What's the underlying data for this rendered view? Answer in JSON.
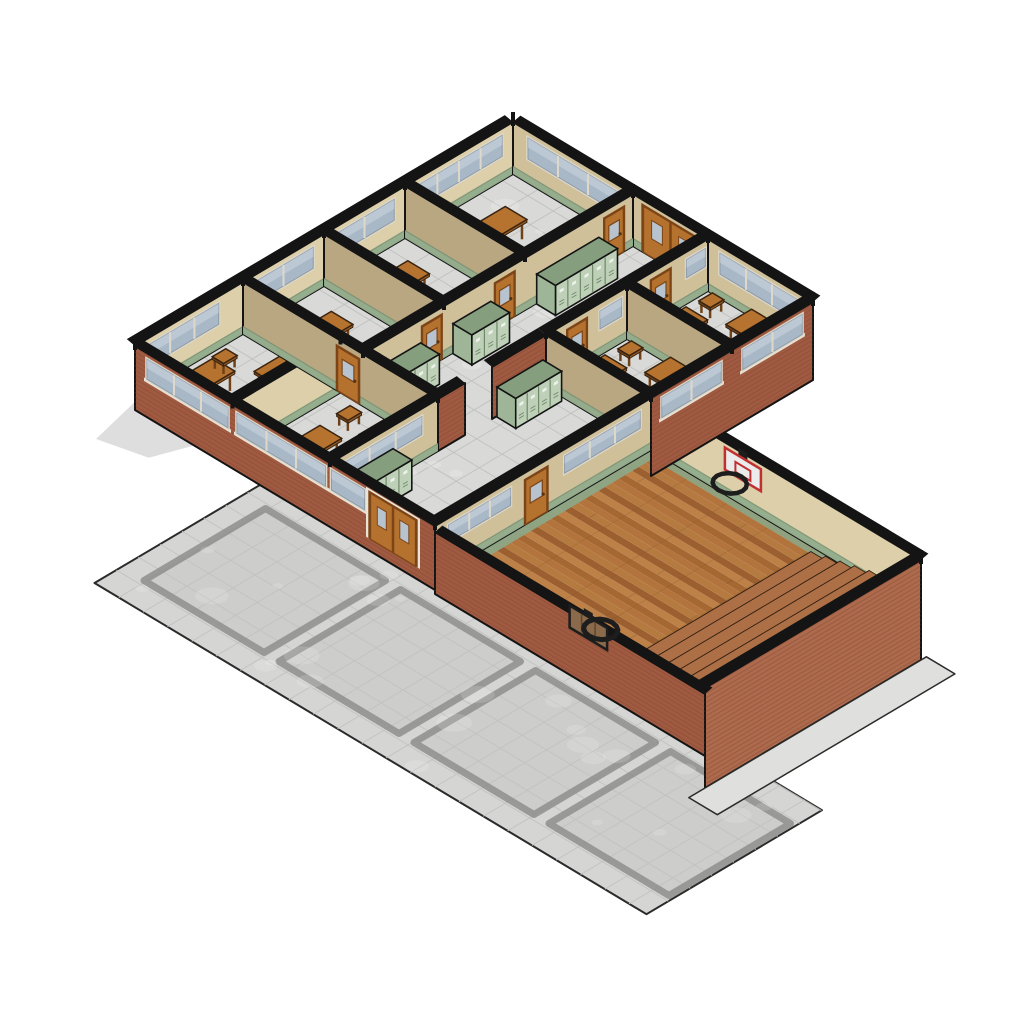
{
  "scene_name": "isometric-school-building-model",
  "palette": {
    "background": "#ffffff",
    "outline": "#141414",
    "wallTanLight": "#dccfa9",
    "wallTan": "#cfc09a",
    "wallTanDark": "#b9a782",
    "wainscot": "#93ac8c",
    "wainscotDark": "#768f70",
    "brick": "#a05a41",
    "brickLight": "#ad6a4d",
    "brickDark": "#7c4530",
    "tileFloor": "#d9dad8",
    "tileLine": "#bfc0be",
    "plaza": "#d5d6d4",
    "plazaLine": "#c2c3c1",
    "plazaInset": "#cdcecc",
    "plazaGroove": "#8e8f8d",
    "sidewalk": "#dfe0dd",
    "wood": [
      "#b2743c",
      "#a66832",
      "#bd8148",
      "#9c6030",
      "#b57a40"
    ],
    "woodSeam": "#7e5224",
    "gymTrim": "#8da787",
    "bleacherTop": "#ad6f46",
    "bleacherRiser": "#7f4e33",
    "lockerFront": "#bed0b7",
    "lockerSide": "#9eb697",
    "lockerTop": "#859e7d",
    "lockerLine": "#5f7a59",
    "lockerPlate": "#edf2ea",
    "door": "#b5722e",
    "doorDark": "#7d4517",
    "doorGlass": "#b7c3cf",
    "glass": "#a9b8c7",
    "glassLight": "#ccd5de",
    "frame": "#ddd8ca",
    "sill": "#e9e4d5",
    "deskTop": "#b5732f",
    "deskSide": "#9a5c26",
    "deskLeg": "#6f4119",
    "backboard": "#ebebeb",
    "backboardTrim": "#c03030",
    "backboardRear": "#8a6a4a",
    "slat": "#5f4630",
    "hoopRim": "#1d1d1d",
    "shadow": "rgba(70,70,70,0.18)"
  },
  "iso": {
    "origin": [
      135,
      398
    ],
    "ua": [
      13.5,
      -8
    ],
    "ub": [
      15,
      9
    ],
    "wallHeight": 52
  },
  "plaza": {
    "a1": -13,
    "a2": 0,
    "b1": 9,
    "b2": 45.8,
    "tile": 1.62,
    "squares": [
      [
        -11,
        -2,
        10.5,
        18.5
      ],
      [
        -11,
        -2,
        19.5,
        27.5
      ],
      [
        -11,
        -2,
        28.5,
        36.5
      ],
      [
        -11,
        -2,
        37.5,
        45.5
      ]
    ]
  },
  "shadow": [
    [
      -0.2,
      0.2
    ],
    [
      -4,
      1
    ],
    [
      -3.2,
      3.8
    ],
    [
      -0.2,
      4.8
    ]
  ],
  "wingFloor": {
    "a1": 0,
    "a2": 28,
    "b1": 0,
    "b2": 20,
    "tile": 1.7
  },
  "gymFloor": {
    "a1": 0,
    "a2": 16,
    "b1": 20,
    "b2": 38,
    "plank": 0.5
  },
  "sidewalkStrip": [
    [
      -1.2,
      38
    ],
    [
      16.4,
      38
    ],
    [
      16.4,
      39.9
    ],
    [
      -1.2,
      39.9
    ]
  ],
  "walls": [
    {
      "id": "wall-nw-exterior",
      "p1": [
        0,
        0
      ],
      "p2": [
        28,
        0
      ],
      "fill": "wallTanLight",
      "cap": [
        0,
        -0.55
      ],
      "feats": [
        {
          "t": "wains"
        },
        {
          "t": "win",
          "u": [
            0.8,
            6.2
          ],
          "y": [
            24,
            45
          ]
        },
        {
          "t": "win",
          "u": [
            8.8,
            13.2
          ],
          "y": [
            24,
            45
          ]
        },
        {
          "t": "win",
          "u": [
            14.8,
            19.2
          ],
          "y": [
            24,
            45
          ]
        },
        {
          "t": "win",
          "u": [
            20.8,
            27.2
          ],
          "y": [
            24,
            45
          ]
        }
      ]
    },
    {
      "id": "wall-ne-exterior",
      "p1": [
        28,
        0
      ],
      "p2": [
        28,
        20
      ],
      "fill": "wallTan",
      "cap": [
        0.55,
        0
      ],
      "feats": [
        {
          "t": "wains"
        },
        {
          "t": "win",
          "u": [
            1,
            7
          ],
          "y": [
            24,
            45
          ]
        },
        {
          "t": "ddoor",
          "u": [
            8.7,
            12.3
          ],
          "y": [
            0,
            46
          ]
        },
        {
          "t": "win",
          "u": [
            13.8,
            19
          ],
          "y": [
            24,
            45
          ]
        }
      ]
    },
    {
      "id": "wall-sw-exterior",
      "p1": [
        0,
        0
      ],
      "p2": [
        0,
        20
      ],
      "fill": "brick",
      "drop": 12,
      "cap": [
        0.55,
        0
      ],
      "feats": [
        {
          "t": "winB",
          "u": [
            0.8,
            6.2
          ],
          "y": [
            26,
            46
          ]
        },
        {
          "t": "winB",
          "u": [
            6.8,
            12.7
          ],
          "y": [
            26,
            46
          ]
        },
        {
          "t": "winB",
          "u": [
            13.1,
            15.3
          ],
          "y": [
            26,
            46
          ]
        },
        {
          "t": "ddoorB",
          "u": [
            15.7,
            18.7
          ],
          "y": [
            0,
            46
          ]
        }
      ]
    },
    {
      "id": "wall-se-classrooms",
      "p1": [
        16,
        20
      ],
      "p2": [
        28,
        20
      ],
      "fill": "brick",
      "drop": 26,
      "cap": [
        0,
        -0.55
      ],
      "feats": [
        {
          "t": "winB",
          "u": [
            0.8,
            5.2
          ],
          "y": [
            26,
            46
          ]
        },
        {
          "t": "winB",
          "u": [
            6.8,
            11.2
          ],
          "y": [
            26,
            46
          ]
        }
      ]
    },
    {
      "id": "wall-room-divider-b65",
      "p1": [
        0,
        6.5
      ],
      "p2": [
        8,
        6.5
      ],
      "fill": "wallTanLight",
      "cap": [
        0,
        -0.55
      ],
      "feats": [
        {
          "t": "wains"
        }
      ]
    },
    {
      "id": "wall-a8",
      "p1": [
        8,
        0
      ],
      "p2": [
        8,
        13
      ],
      "fill": "wallTanDark",
      "cap": [
        0.55,
        0
      ],
      "feats": [
        {
          "t": "wains"
        },
        {
          "t": "door",
          "u": [
            6.3,
            7.7
          ],
          "y": [
            0,
            44
          ]
        }
      ]
    },
    {
      "id": "wall-hall-north",
      "p1": [
        8,
        8
      ],
      "p2": [
        28,
        8
      ],
      "fill": "wallTan",
      "cap": [
        0,
        -0.55
      ],
      "feats": [
        {
          "t": "wains"
        },
        {
          "t": "door",
          "u": [
            4.4,
            5.8
          ],
          "y": [
            0,
            44
          ]
        },
        {
          "t": "door",
          "u": [
            9.8,
            11.2
          ],
          "y": [
            0,
            44
          ]
        },
        {
          "t": "door",
          "u": [
            17.9,
            19.3
          ],
          "y": [
            0,
            44
          ]
        }
      ]
    },
    {
      "id": "wall-a14",
      "p1": [
        14,
        0
      ],
      "p2": [
        14,
        8
      ],
      "fill": "wallTanDark",
      "cap": [
        0.55,
        0
      ],
      "feats": [
        {
          "t": "wains"
        }
      ]
    },
    {
      "id": "wall-a20",
      "p1": [
        20,
        0
      ],
      "p2": [
        20,
        8
      ],
      "fill": "wallTanDark",
      "cap": [
        0.55,
        0
      ],
      "feats": [
        {
          "t": "wains"
        }
      ]
    },
    {
      "id": "wall-brick-pier-west",
      "p1": [
        8,
        13
      ],
      "p2": [
        10,
        13
      ],
      "fill": "brick",
      "cap": [
        0,
        -0.55
      ],
      "feats": []
    },
    {
      "id": "wall-brick-pier-east",
      "p1": [
        12,
        13
      ],
      "p2": [
        16,
        13
      ],
      "fill": "brick",
      "cap": [
        0,
        -0.55
      ],
      "feats": []
    },
    {
      "id": "wall-lobby-north",
      "p1": [
        0,
        13
      ],
      "p2": [
        8,
        13
      ],
      "fill": "wallTan",
      "cap": [
        0,
        -0.55
      ],
      "feats": [
        {
          "t": "wains"
        },
        {
          "t": "win",
          "u": [
            1,
            6.8
          ],
          "y": [
            26,
            44
          ]
        }
      ]
    },
    {
      "id": "wall-hall-south-east",
      "p1": [
        16,
        13
      ],
      "p2": [
        28,
        13
      ],
      "fill": "wallTan",
      "cap": [
        0,
        -0.55
      ],
      "feats": [
        {
          "t": "wains"
        },
        {
          "t": "door",
          "u": [
            1.6,
            3
          ],
          "y": [
            0,
            44
          ]
        },
        {
          "t": "win",
          "u": [
            4,
            5.6
          ],
          "y": [
            26,
            44
          ]
        },
        {
          "t": "door",
          "u": [
            7.8,
            9.2
          ],
          "y": [
            0,
            44
          ]
        },
        {
          "t": "win",
          "u": [
            10.4,
            11.8
          ],
          "y": [
            26,
            44
          ]
        }
      ]
    },
    {
      "id": "wall-a16-lobby",
      "p1": [
        16,
        13
      ],
      "p2": [
        16,
        20
      ],
      "fill": "wallTanDark",
      "cap": [
        0.55,
        0
      ],
      "feats": [
        {
          "t": "wains"
        }
      ]
    },
    {
      "id": "wall-a22",
      "p1": [
        22,
        13
      ],
      "p2": [
        22,
        20
      ],
      "fill": "wallTanDark",
      "cap": [
        0.55,
        0
      ],
      "feats": [
        {
          "t": "wains"
        }
      ]
    },
    {
      "id": "wall-gym-northwest",
      "p1": [
        0,
        20
      ],
      "p2": [
        16,
        20
      ],
      "fill": "wallTan",
      "cap": [
        0,
        -0.55
      ],
      "feats": [
        {
          "t": "wains"
        },
        {
          "t": "win",
          "u": [
            1,
            5.6
          ],
          "y": [
            28,
            45
          ]
        },
        {
          "t": "door",
          "u": [
            6.7,
            8.3
          ],
          "y": [
            0,
            44
          ]
        },
        {
          "t": "win",
          "u": [
            9.6,
            15.2
          ],
          "y": [
            28,
            45
          ]
        }
      ]
    },
    {
      "id": "wall-gym-northeast",
      "p1": [
        16,
        20
      ],
      "p2": [
        16,
        38
      ],
      "fill": "wallTanLight",
      "cap": [
        0.55,
        0
      ],
      "feats": [
        {
          "t": "wains"
        }
      ]
    },
    {
      "id": "wall-gym-southeast",
      "p1": [
        0,
        38
      ],
      "p2": [
        16,
        38
      ],
      "fill": "brickLight",
      "drop": 48,
      "cap": [
        0,
        -0.55
      ],
      "feats": []
    },
    {
      "id": "wall-gym-southwest",
      "p1": [
        0,
        20
      ],
      "p2": [
        0,
        38
      ],
      "h": 46,
      "fill": "brick",
      "drop": 16,
      "cap": [
        0.55,
        0
      ],
      "feats": []
    }
  ],
  "lockers": [
    {
      "id": "locker-bank-hall-1",
      "a1": 8.6,
      "a2": 12.2,
      "b": 8.06
    },
    {
      "id": "locker-bank-hall-2",
      "a1": 14.6,
      "a2": 17.4,
      "b": 8.06
    },
    {
      "id": "locker-bank-hall-3",
      "a1": 20.8,
      "a2": 25.4,
      "b": 8.06
    },
    {
      "id": "locker-bank-lobby-1",
      "a1": 0.8,
      "a2": 4.6,
      "b": 13.06
    },
    {
      "id": "locker-bank-lobby-2",
      "a1": 12.3,
      "a2": 15.7,
      "b": 13.06
    }
  ],
  "furniture": {
    "classroom-west-a": {
      "tables": [
        [
          3.2,
          2.2
        ],
        [
          5.8,
          4.3
        ]
      ],
      "stools": [
        [
          2.3,
          4.8
        ],
        [
          5.2,
          1.3
        ]
      ]
    },
    "classroom-west-b": {
      "tables": [
        [
          3,
          9.5
        ],
        [
          5.8,
          11.3
        ]
      ],
      "stools": [
        [
          2.2,
          11.8
        ],
        [
          6.3,
          8.6
        ]
      ]
    },
    "classroom-north-a": {
      "tables": [
        [
          10.5,
          3.5
        ]
      ],
      "stools": [
        [
          12.3,
          5.6
        ]
      ]
    },
    "classroom-north-b": {
      "tables": [
        [
          16.5,
          3.2
        ]
      ],
      "stools": [
        [
          15.4,
          5.6
        ]
      ]
    },
    "classroom-north-c": {
      "tables": [
        [
          23.5,
          3.4
        ]
      ],
      "stools": [
        [
          25.3,
          5.7
        ]
      ]
    },
    "classroom-east-a": {
      "tables": [
        [
          18,
          15
        ],
        [
          20.3,
          17.3
        ]
      ],
      "stools": [
        [
          17,
          17.6
        ],
        [
          20.8,
          14.3
        ]
      ]
    },
    "classroom-east-b": {
      "tables": [
        [
          24,
          15
        ],
        [
          26.3,
          17.3
        ]
      ],
      "stools": [
        [
          23.2,
          17.6
        ],
        [
          26.8,
          14.3
        ]
      ]
    }
  },
  "bleachers": {
    "a1": 0.6,
    "a2": 15.4,
    "b0": 31.2,
    "steps": 7,
    "depth": 0.97,
    "rise": 4
  },
  "hoops": {
    "ne": {
      "b": 26.15
    },
    "sw": {
      "b": 30.15
    }
  },
  "posts": [
    [
      0,
      0
    ],
    [
      8,
      0
    ],
    [
      14,
      0
    ],
    [
      20,
      0
    ],
    [
      28,
      0
    ],
    [
      28,
      8
    ],
    [
      28,
      13
    ],
    [
      28,
      20
    ],
    [
      22,
      13
    ],
    [
      16,
      13
    ],
    [
      16,
      20
    ],
    [
      8,
      13
    ],
    [
      8,
      8
    ],
    [
      8,
      6.5
    ],
    [
      0,
      6.5
    ],
    [
      0,
      13
    ],
    [
      0,
      20
    ],
    [
      14,
      8
    ],
    [
      20,
      8
    ],
    [
      22,
      20
    ],
    [
      16,
      38
    ],
    [
      0,
      38
    ]
  ]
}
